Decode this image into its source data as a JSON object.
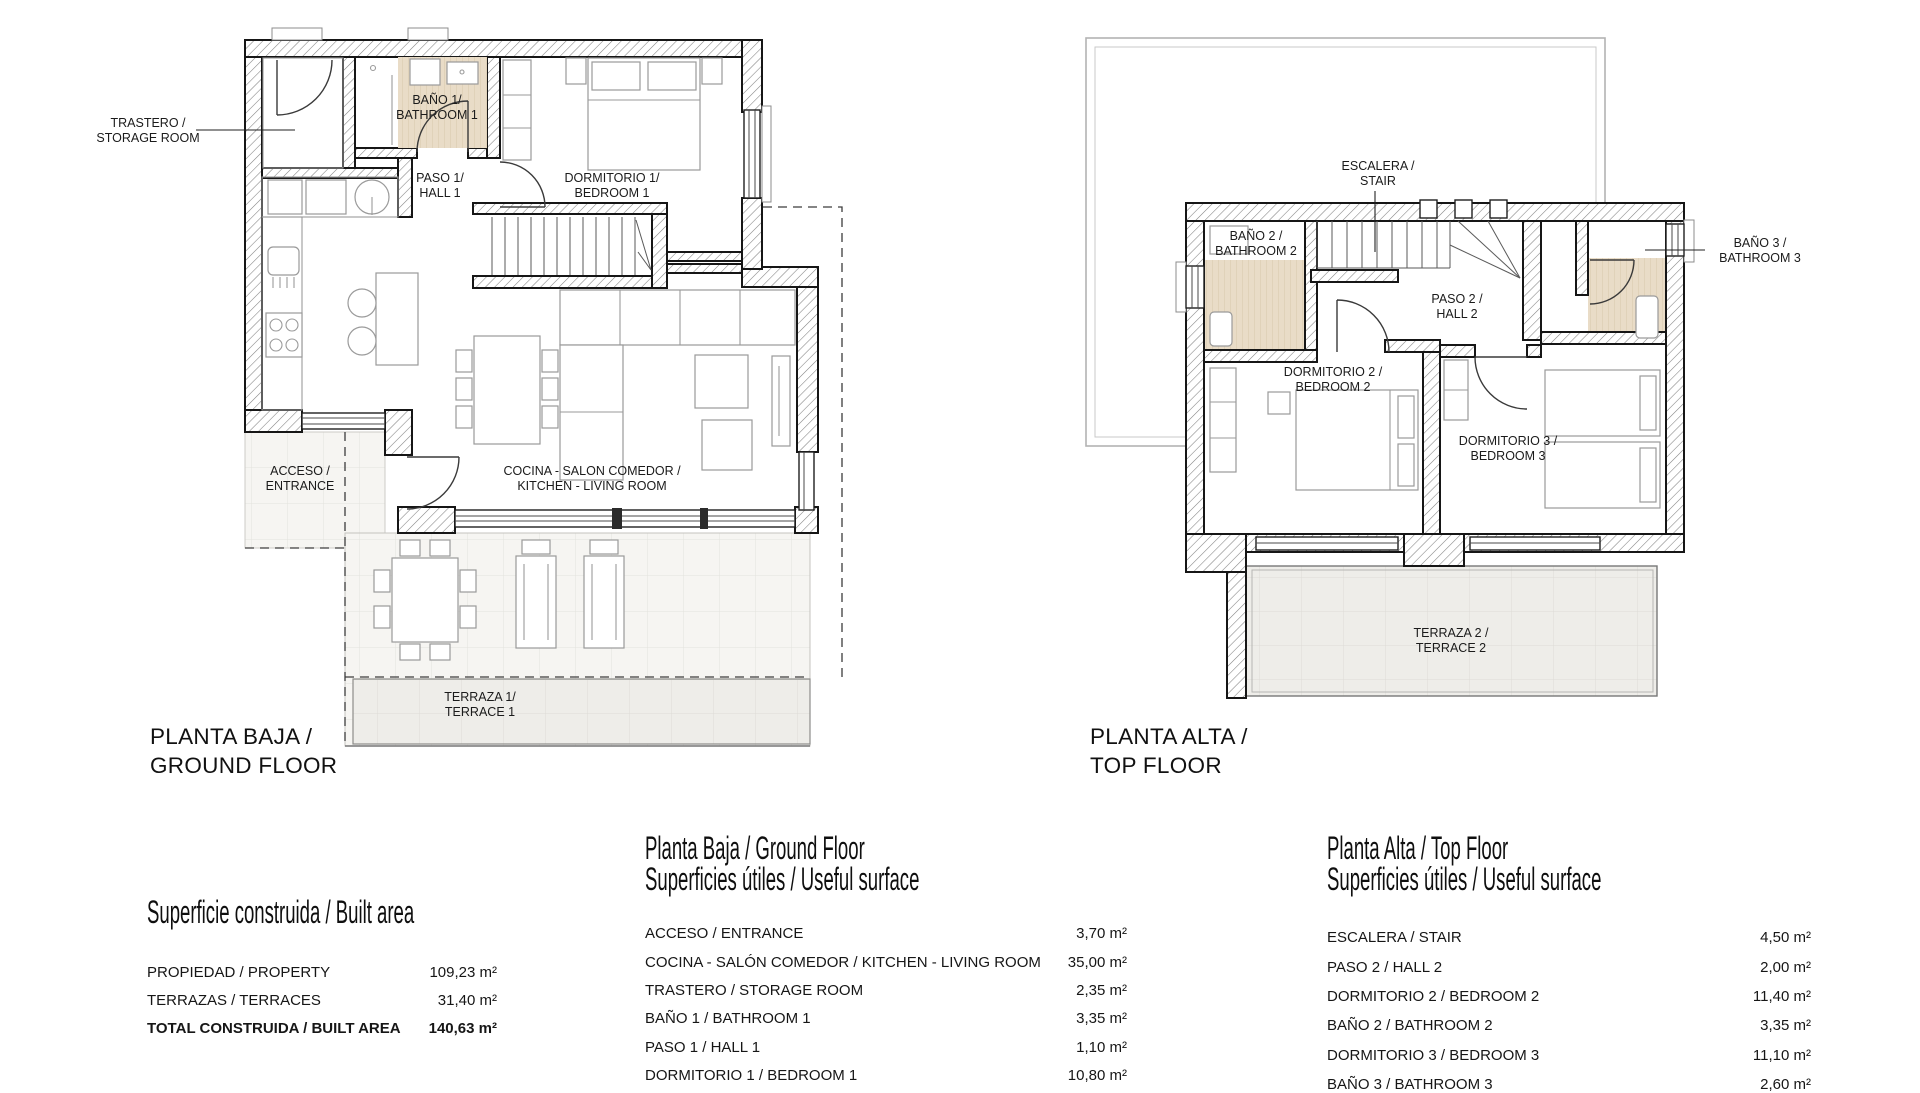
{
  "colors": {
    "wall_line": "#161616",
    "bath_floor_beige": "#e9dcc7",
    "terrace_tile": "#efeeea",
    "roof_outline": "#b3b3b3"
  },
  "ground_floor": {
    "title_line1": "PLANTA BAJA /",
    "title_line2": "GROUND FLOOR",
    "rooms": {
      "trastero_l1": "TRASTERO /",
      "trastero_l2": "STORAGE ROOM",
      "bano1_l1": "BAÑO 1/",
      "bano1_l2": "BATHROOM 1",
      "paso1_l1": "PASO 1/",
      "paso1_l2": "HALL 1",
      "dorm1_l1": "DORMITORIO 1/",
      "dorm1_l2": "BEDROOM 1",
      "cocina_l1": "COCINA - SALON COMEDOR /",
      "cocina_l2": "KITCHEN - LIVING ROOM",
      "acceso_l1": "ACCESO /",
      "acceso_l2": "ENTRANCE",
      "terraza1_l1": "TERRAZA 1/",
      "terraza1_l2": "TERRACE 1"
    }
  },
  "top_floor": {
    "title_line1": "PLANTA ALTA /",
    "title_line2": "TOP FLOOR",
    "rooms": {
      "escalera_l1": "ESCALERA /",
      "escalera_l2": "STAIR",
      "bano2_l1": "BAÑO 2 /",
      "bano2_l2": "BATHROOM 2",
      "bano3_l1": "BAÑO 3 /",
      "bano3_l2": "BATHROOM 3",
      "paso2_l1": "PASO 2 /",
      "paso2_l2": "HALL 2",
      "dorm2_l1": "DORMITORIO 2 /",
      "dorm2_l2": "BEDROOM 2",
      "dorm3_l1": "DORMITORIO 3 /",
      "dorm3_l2": "BEDROOM 3",
      "terraza2_l1": "TERRAZA 2 /",
      "terraza2_l2": "TERRACE 2"
    }
  },
  "built_area_table": {
    "title": "Superficie construida / Built area",
    "rows": [
      {
        "label": "PROPIEDAD / PROPERTY",
        "value": "109,23 m²"
      },
      {
        "label": "TERRAZAS / TERRACES",
        "value": "31,40 m²"
      },
      {
        "label": "TOTAL CONSTRUIDA / BUILT AREA",
        "value": "140,63 m²"
      }
    ]
  },
  "ground_table": {
    "title_line1": "Planta Baja / Ground Floor",
    "title_line2": "Superficies útiles / Useful surface",
    "rows": [
      {
        "label": "ACCESO / ENTRANCE",
        "value": "3,70 m²"
      },
      {
        "label": "COCINA - SALÓN COMEDOR / KITCHEN - LIVING ROOM",
        "value": "35,00 m²"
      },
      {
        "label": "TRASTERO / STORAGE ROOM",
        "value": "2,35 m²"
      },
      {
        "label": "BAÑO 1 / BATHROOM 1",
        "value": "3,35 m²"
      },
      {
        "label": "PASO 1 / HALL 1",
        "value": "1,10 m²"
      },
      {
        "label": "DORMITORIO 1 / BEDROOM 1",
        "value": "10,80 m²"
      }
    ]
  },
  "top_table": {
    "title_line1": "Planta Alta / Top Floor",
    "title_line2": "Superficies útiles / Useful surface",
    "rows": [
      {
        "label": "ESCALERA / STAIR",
        "value": "4,50 m²"
      },
      {
        "label": "PASO 2 / HALL 2",
        "value": "2,00 m²"
      },
      {
        "label": "DORMITORIO 2 / BEDROOM 2",
        "value": "11,40 m²"
      },
      {
        "label": "BAÑO 2 / BATHROOM 2",
        "value": "3,35 m²"
      },
      {
        "label": "DORMITORIO 3 / BEDROOM 3",
        "value": "11,10 m²"
      },
      {
        "label": "BAÑO 3 / BATHROOM 3",
        "value": "2,60 m²"
      }
    ]
  }
}
